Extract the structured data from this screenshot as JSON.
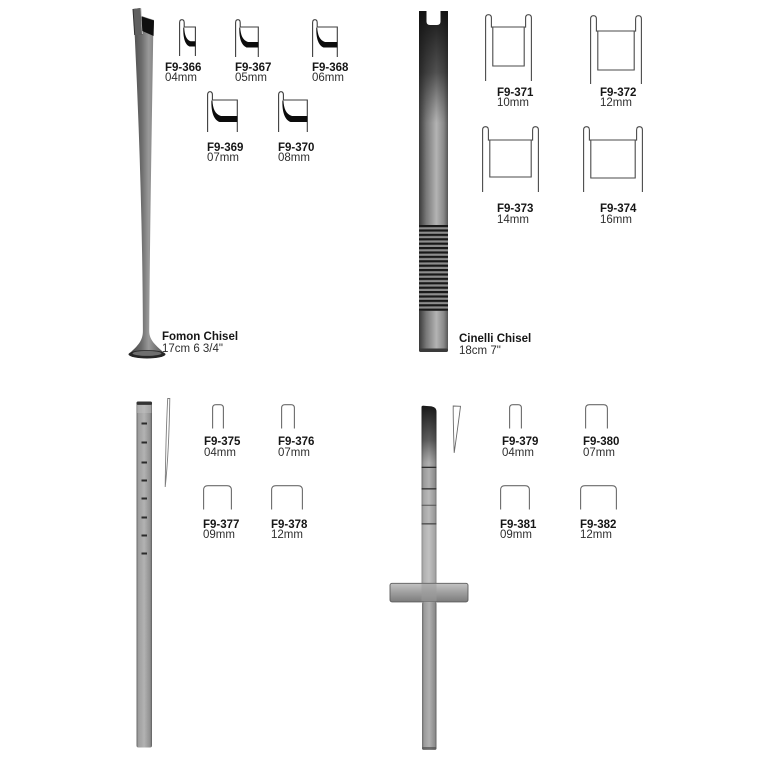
{
  "page": {
    "background": "#ffffff",
    "text_color": "#161616"
  },
  "groups": [
    {
      "name": "Fomon Chisel",
      "dimensions": "17cm 6 3/4\"",
      "items": [
        {
          "code": "F9-366",
          "size": "04mm"
        },
        {
          "code": "F9-367",
          "size": "05mm"
        },
        {
          "code": "F9-368",
          "size": "06mm"
        },
        {
          "code": "F9-369",
          "size": "07mm"
        },
        {
          "code": "F9-370",
          "size": "08mm"
        }
      ]
    },
    {
      "name": "Cinelli Chisel",
      "dimensions": "18cm 7\"",
      "items": [
        {
          "code": "F9-371",
          "size": "10mm"
        },
        {
          "code": "F9-372",
          "size": "12mm"
        },
        {
          "code": "F9-373",
          "size": "14mm"
        },
        {
          "code": "F9-374",
          "size": "16mm"
        }
      ]
    },
    {
      "items": [
        {
          "code": "F9-375",
          "size": "04mm"
        },
        {
          "code": "F9-376",
          "size": "07mm"
        },
        {
          "code": "F9-377",
          "size": "09mm"
        },
        {
          "code": "F9-378",
          "size": "12mm"
        }
      ]
    },
    {
      "items": [
        {
          "code": "F9-379",
          "size": "04mm"
        },
        {
          "code": "F9-380",
          "size": "07mm"
        },
        {
          "code": "F9-381",
          "size": "09mm"
        },
        {
          "code": "F9-382",
          "size": "12mm"
        }
      ]
    }
  ]
}
